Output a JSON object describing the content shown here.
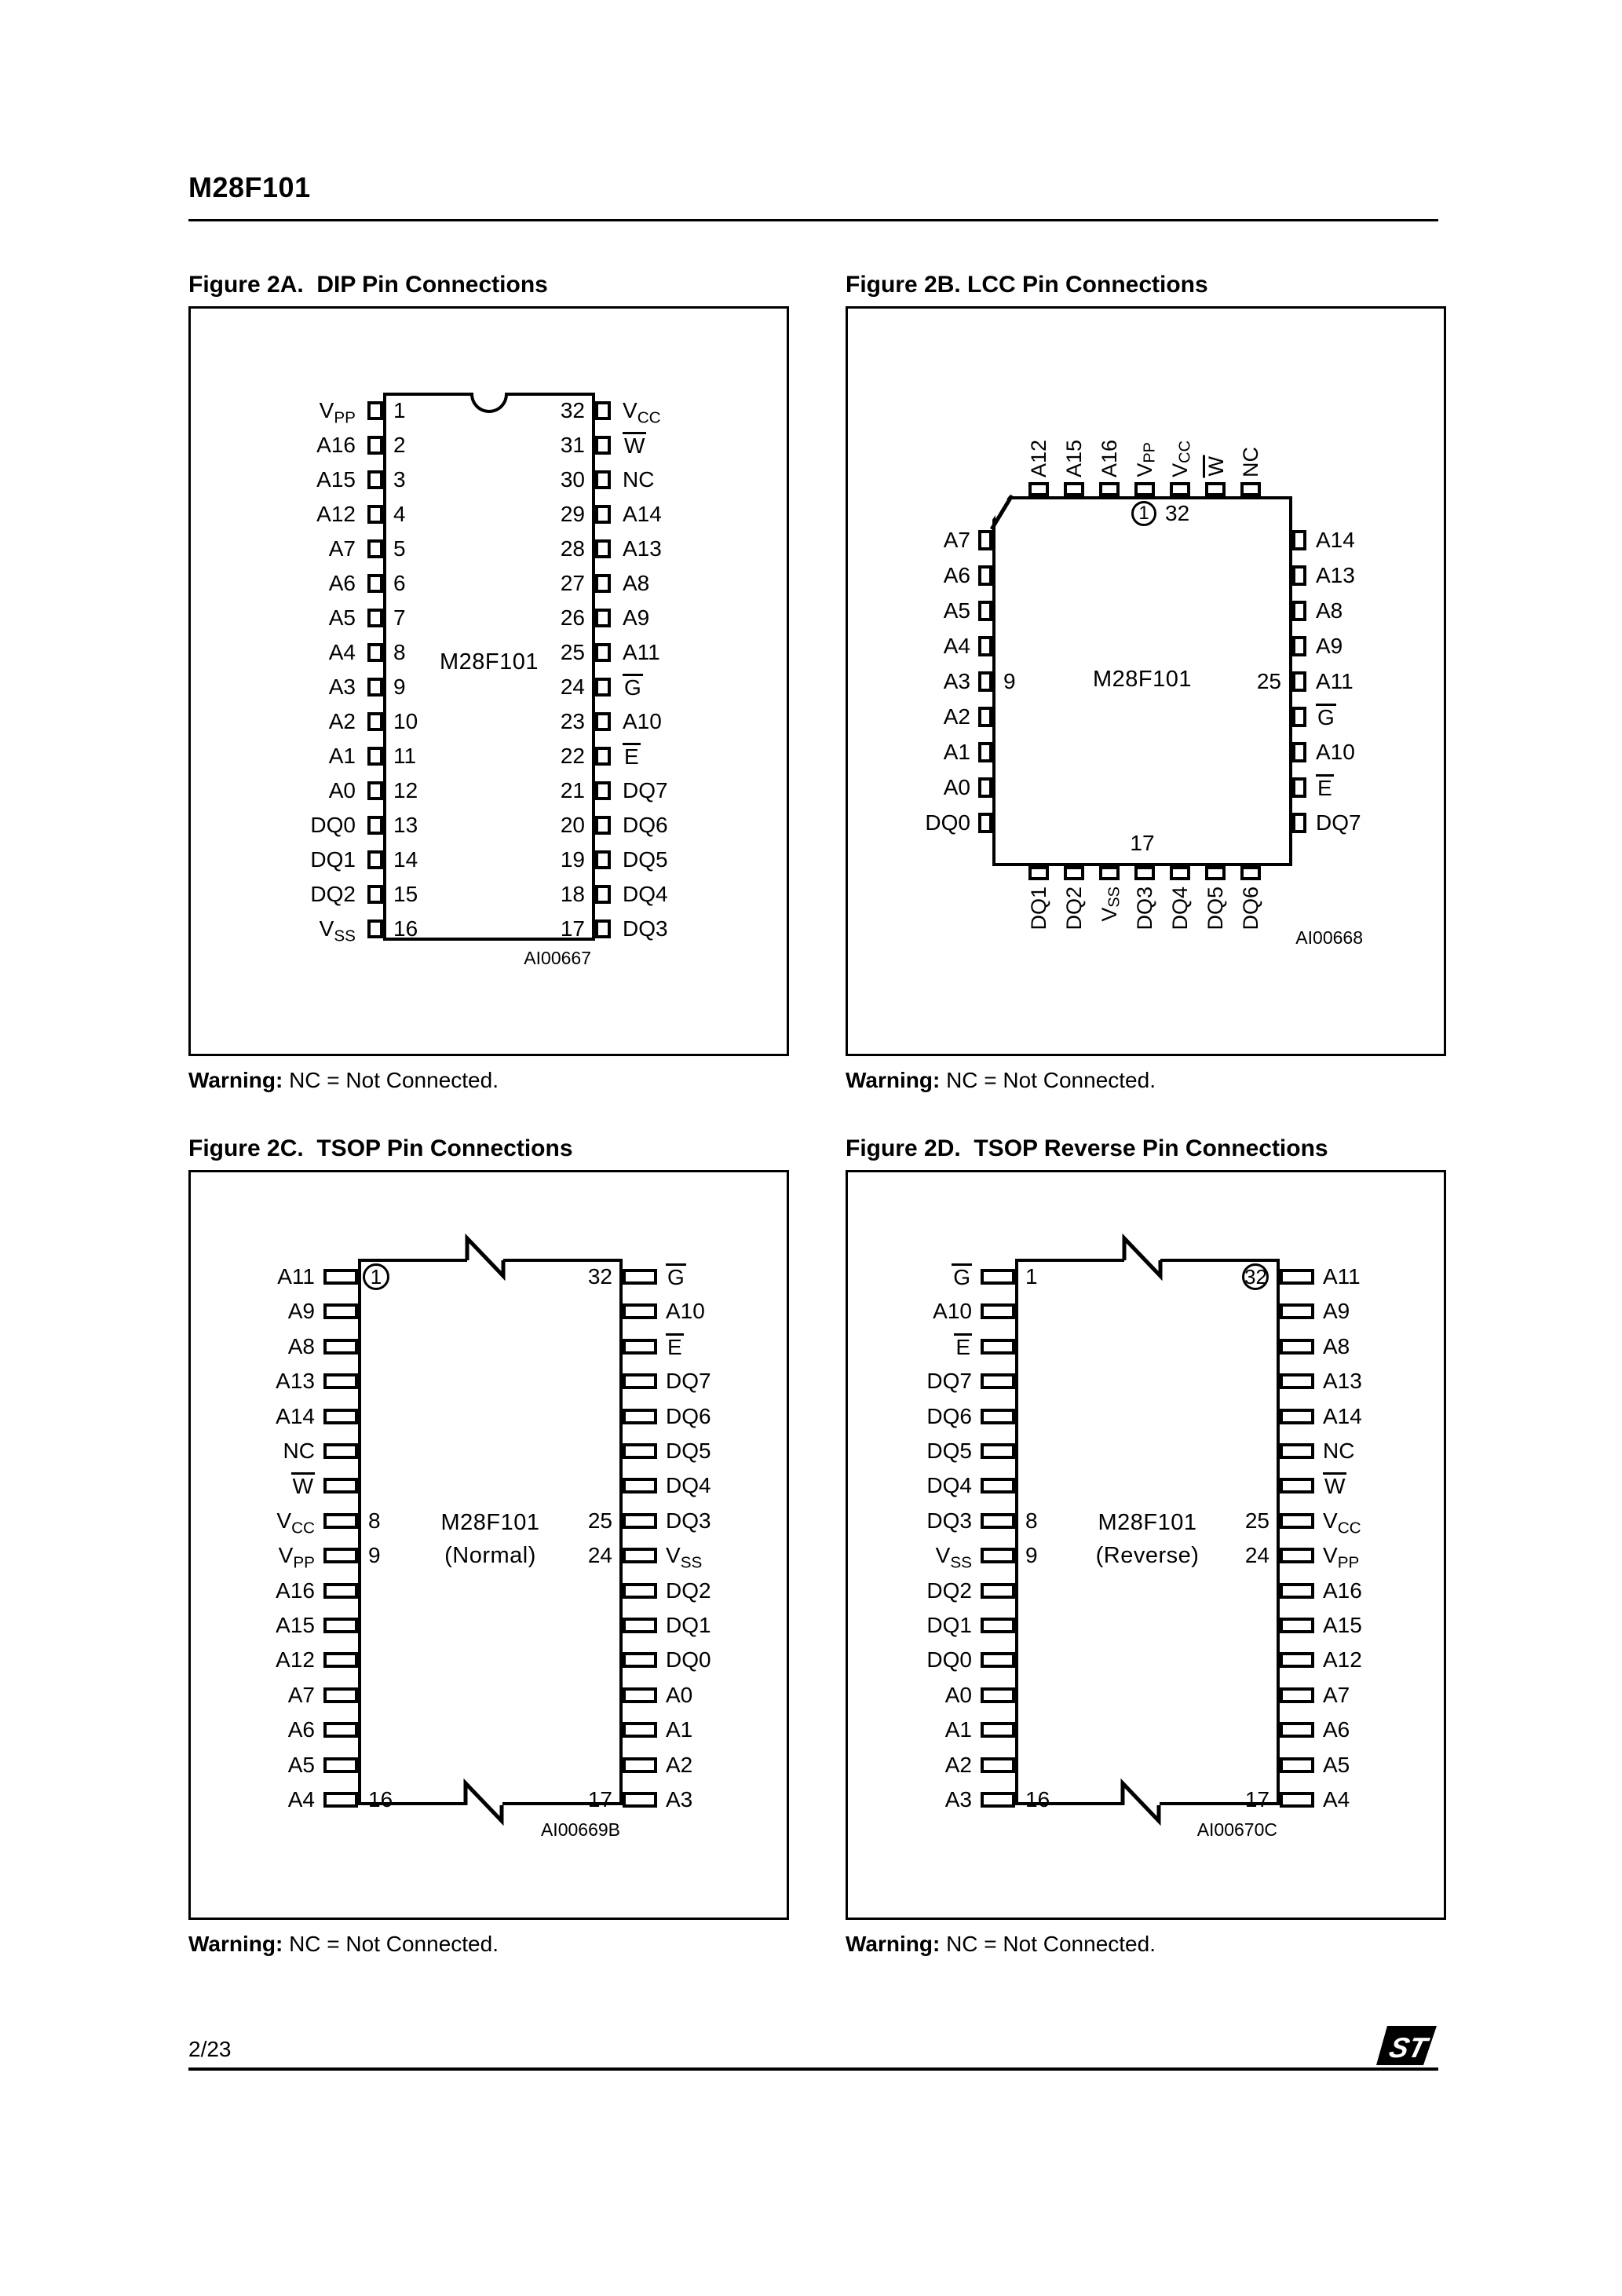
{
  "header": {
    "title": "M28F101"
  },
  "footer": {
    "page_number": "2/23",
    "logo_name": "st-logo"
  },
  "warning": {
    "label": "Warning:",
    "text": "NC = Not Connected."
  },
  "figures": {
    "fig2a": {
      "title": "Figure 2A.  DIP Pin Connections",
      "package": "dip",
      "chip_label": "M28F101",
      "ref_code": "AI00667",
      "left_pins": [
        {
          "t": "V",
          "sub": "PP",
          "num": "1"
        },
        {
          "t": "A16",
          "num": "2"
        },
        {
          "t": "A15",
          "num": "3"
        },
        {
          "t": "A12",
          "num": "4"
        },
        {
          "t": "A7",
          "num": "5"
        },
        {
          "t": "A6",
          "num": "6"
        },
        {
          "t": "A5",
          "num": "7"
        },
        {
          "t": "A4",
          "num": "8"
        },
        {
          "t": "A3",
          "num": "9"
        },
        {
          "t": "A2",
          "num": "10"
        },
        {
          "t": "A1",
          "num": "11"
        },
        {
          "t": "A0",
          "num": "12"
        },
        {
          "t": "DQ0",
          "num": "13"
        },
        {
          "t": "DQ1",
          "num": "14"
        },
        {
          "t": "DQ2",
          "num": "15"
        },
        {
          "t": "V",
          "sub": "SS",
          "num": "16"
        }
      ],
      "right_pins": [
        {
          "t": "V",
          "sub": "CC",
          "num": "32"
        },
        {
          "t": "W",
          "bar": true,
          "num": "31"
        },
        {
          "t": "NC",
          "num": "30"
        },
        {
          "t": "A14",
          "num": "29"
        },
        {
          "t": "A13",
          "num": "28"
        },
        {
          "t": "A8",
          "num": "27"
        },
        {
          "t": "A9",
          "num": "26"
        },
        {
          "t": "A11",
          "num": "25"
        },
        {
          "t": "G",
          "bar": true,
          "num": "24"
        },
        {
          "t": "A10",
          "num": "23"
        },
        {
          "t": "E",
          "bar": true,
          "num": "22"
        },
        {
          "t": "DQ7",
          "num": "21"
        },
        {
          "t": "DQ6",
          "num": "20"
        },
        {
          "t": "DQ5",
          "num": "19"
        },
        {
          "t": "DQ4",
          "num": "18"
        },
        {
          "t": "DQ3",
          "num": "17"
        }
      ]
    },
    "fig2b": {
      "title": "Figure 2B. LCC Pin Connections",
      "package": "lcc",
      "chip_label": "M28F101",
      "ref_code": "AI00668",
      "pin1_num": "1",
      "pin1_adjacent_num": "32",
      "left_mid_num": "9",
      "right_mid_num": "25",
      "bottom_center_num": "17",
      "top_pins": [
        {
          "t": "A12"
        },
        {
          "t": "A15"
        },
        {
          "t": "A16"
        },
        {
          "t": "V",
          "sub": "PP"
        },
        {
          "t": "V",
          "sub": "CC"
        },
        {
          "t": "W",
          "bar": true
        },
        {
          "t": "NC"
        }
      ],
      "left_pins": [
        {
          "t": "A7"
        },
        {
          "t": "A6"
        },
        {
          "t": "A5"
        },
        {
          "t": "A4"
        },
        {
          "t": "A3"
        },
        {
          "t": "A2"
        },
        {
          "t": "A1"
        },
        {
          "t": "A0"
        },
        {
          "t": "DQ0"
        }
      ],
      "right_pins": [
        {
          "t": "A14"
        },
        {
          "t": "A13"
        },
        {
          "t": "A8"
        },
        {
          "t": "A9"
        },
        {
          "t": "A11"
        },
        {
          "t": "G",
          "bar": true
        },
        {
          "t": "A10"
        },
        {
          "t": "E",
          "bar": true
        },
        {
          "t": "DQ7"
        }
      ],
      "bottom_pins": [
        {
          "t": "DQ1"
        },
        {
          "t": "DQ2"
        },
        {
          "t": "V",
          "sub": "SS"
        },
        {
          "t": "DQ3"
        },
        {
          "t": "DQ4"
        },
        {
          "t": "DQ5"
        },
        {
          "t": "DQ6"
        }
      ]
    },
    "fig2c": {
      "title": "Figure 2C.  TSOP Pin Connections",
      "package": "tsop",
      "chip_label": "M28F101",
      "chip_sublabel": "(Normal)",
      "ref_code": "AI00669B",
      "left_pins": [
        {
          "t": "A11",
          "num": "1",
          "circle": true
        },
        {
          "t": "A9"
        },
        {
          "t": "A8"
        },
        {
          "t": "A13"
        },
        {
          "t": "A14"
        },
        {
          "t": "NC"
        },
        {
          "t": "W",
          "bar": true
        },
        {
          "t": "V",
          "sub": "CC",
          "num": "8"
        },
        {
          "t": "V",
          "sub": "PP",
          "num": "9"
        },
        {
          "t": "A16"
        },
        {
          "t": "A15"
        },
        {
          "t": "A12"
        },
        {
          "t": "A7"
        },
        {
          "t": "A6"
        },
        {
          "t": "A5"
        },
        {
          "t": "A4",
          "num": "16"
        }
      ],
      "right_pins": [
        {
          "t": "G",
          "bar": true,
          "num": "32"
        },
        {
          "t": "A10"
        },
        {
          "t": "E",
          "bar": true
        },
        {
          "t": "DQ7"
        },
        {
          "t": "DQ6"
        },
        {
          "t": "DQ5"
        },
        {
          "t": "DQ4"
        },
        {
          "t": "DQ3",
          "num": "25"
        },
        {
          "t": "V",
          "sub": "SS",
          "num": "24"
        },
        {
          "t": "DQ2"
        },
        {
          "t": "DQ1"
        },
        {
          "t": "DQ0"
        },
        {
          "t": "A0"
        },
        {
          "t": "A1"
        },
        {
          "t": "A2"
        },
        {
          "t": "A3",
          "num": "17"
        }
      ]
    },
    "fig2d": {
      "title": "Figure 2D.  TSOP Reverse Pin Connections",
      "package": "tsop",
      "chip_label": "M28F101",
      "chip_sublabel": "(Reverse)",
      "ref_code": "AI00670C",
      "left_pins": [
        {
          "t": "G",
          "bar": true,
          "num": "1"
        },
        {
          "t": "A10"
        },
        {
          "t": "E",
          "bar": true
        },
        {
          "t": "DQ7"
        },
        {
          "t": "DQ6"
        },
        {
          "t": "DQ5"
        },
        {
          "t": "DQ4"
        },
        {
          "t": "DQ3",
          "num": "8"
        },
        {
          "t": "V",
          "sub": "SS",
          "num": "9"
        },
        {
          "t": "DQ2"
        },
        {
          "t": "DQ1"
        },
        {
          "t": "DQ0"
        },
        {
          "t": "A0"
        },
        {
          "t": "A1"
        },
        {
          "t": "A2"
        },
        {
          "t": "A3",
          "num": "16"
        }
      ],
      "right_pins": [
        {
          "t": "A11",
          "num": "32",
          "circle": true
        },
        {
          "t": "A9"
        },
        {
          "t": "A8"
        },
        {
          "t": "A13"
        },
        {
          "t": "A14"
        },
        {
          "t": "NC"
        },
        {
          "t": "W",
          "bar": true
        },
        {
          "t": "V",
          "sub": "CC",
          "num": "25"
        },
        {
          "t": "V",
          "sub": "PP",
          "num": "24"
        },
        {
          "t": "A16"
        },
        {
          "t": "A15"
        },
        {
          "t": "A12"
        },
        {
          "t": "A7"
        },
        {
          "t": "A6"
        },
        {
          "t": "A5"
        },
        {
          "t": "A4",
          "num": "17"
        }
      ]
    }
  }
}
